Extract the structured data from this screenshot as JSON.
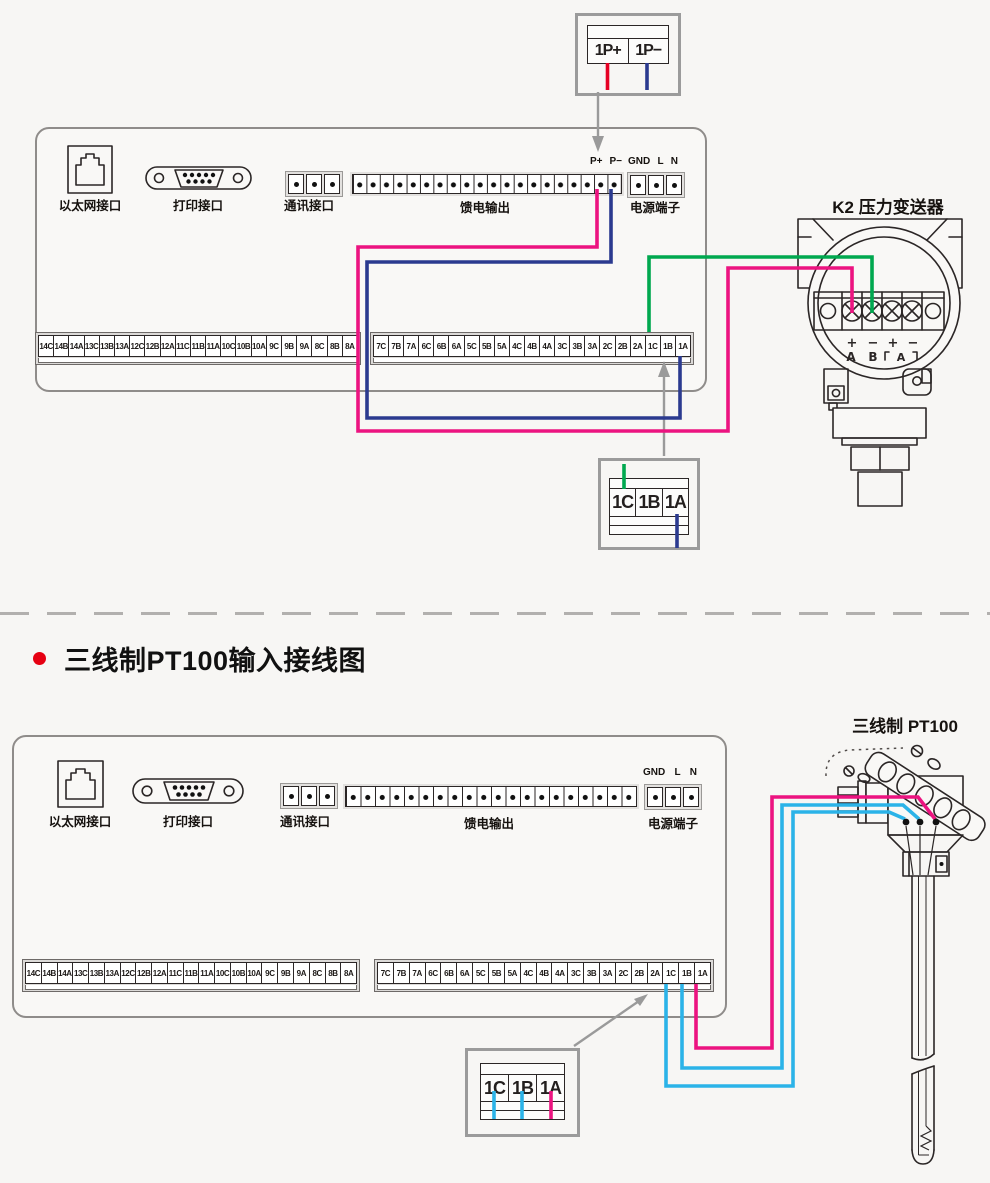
{
  "colors": {
    "red": "#e60023",
    "magenta": "#ec1380",
    "blue": "#2b3a8f",
    "green": "#00a84f",
    "cyan": "#2bb3e8",
    "gray": "#9a9a9a",
    "accent_red": "#e60012",
    "outline": "#2b2626"
  },
  "section_title": "三线制PT100输入接线图",
  "top_diagram": {
    "inset_box": {
      "cells": [
        "1P+",
        "1P−"
      ]
    },
    "panel": {
      "ports": {
        "ethernet": "以太网接口",
        "printer": "打印接口",
        "comm": "通讯接口",
        "feed": "馈电输出",
        "power": "电源端子"
      },
      "power_labels": {
        "p_plus": "P+",
        "p_minus": "P−",
        "gnd": "GND",
        "l": "L",
        "n": "N"
      },
      "strip1": [
        "14C",
        "14B",
        "14A",
        "13C",
        "13B",
        "13A",
        "12C",
        "12B",
        "12A",
        "11C",
        "11B",
        "11A",
        "10C",
        "10B",
        "10A",
        "9C",
        "9B",
        "9A",
        "8C",
        "8B",
        "8A"
      ],
      "strip2": [
        "7C",
        "7B",
        "7A",
        "6C",
        "6B",
        "6A",
        "5C",
        "5B",
        "5A",
        "4C",
        "4B",
        "4A",
        "3C",
        "3B",
        "3A",
        "2C",
        "2B",
        "2A",
        "1C",
        "1B",
        "1A"
      ]
    },
    "transmitter": {
      "title": "K2 压力变送器",
      "terminal_signs": [
        "+",
        "−",
        "+",
        "−"
      ],
      "terminal_letters": [
        "A",
        "B"
      ],
      "bracket_letter": "A"
    },
    "detail_box": {
      "cells": [
        "1C",
        "1B",
        "1A"
      ]
    }
  },
  "bottom_diagram": {
    "panel": {
      "ports": {
        "ethernet": "以太网接口",
        "printer": "打印接口",
        "comm": "通讯接口",
        "feed": "馈电输出",
        "power": "电源端子"
      },
      "power_labels": {
        "gnd": "GND",
        "l": "L",
        "n": "N"
      },
      "strip1": [
        "14C",
        "14B",
        "14A",
        "13C",
        "13B",
        "13A",
        "12C",
        "12B",
        "12A",
        "11C",
        "11B",
        "11A",
        "10C",
        "10B",
        "10A",
        "9C",
        "9B",
        "9A",
        "8C",
        "8B",
        "8A"
      ],
      "strip2": [
        "7C",
        "7B",
        "7A",
        "6C",
        "6B",
        "6A",
        "5C",
        "5B",
        "5A",
        "4C",
        "4B",
        "4A",
        "3C",
        "3B",
        "3A",
        "2C",
        "2B",
        "2A",
        "1C",
        "1B",
        "1A"
      ]
    },
    "sensor": {
      "title": "三线制 PT100"
    },
    "detail_box": {
      "cells": [
        "1C",
        "1B",
        "1A"
      ]
    }
  }
}
